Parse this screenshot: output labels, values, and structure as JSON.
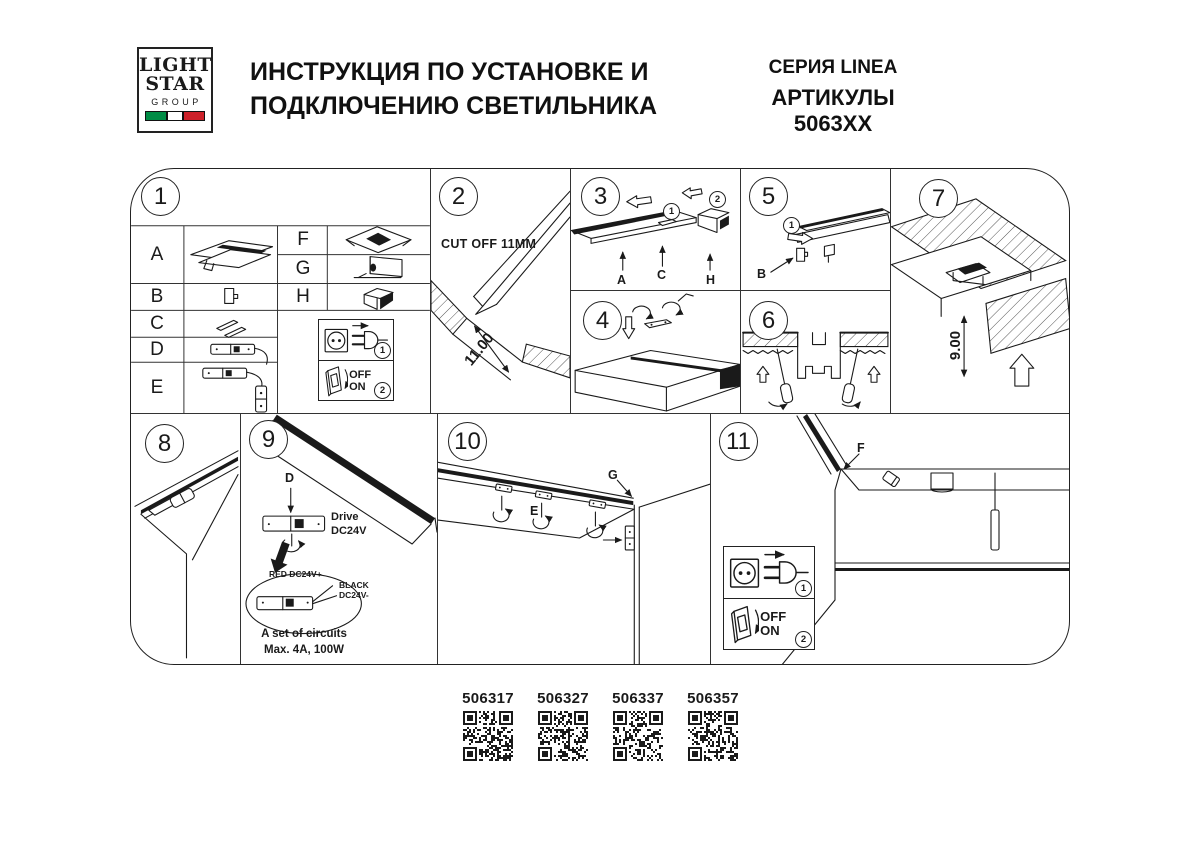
{
  "header": {
    "logo": {
      "word1": "LIGHT",
      "word2": "STAR",
      "word3": "GROUP"
    },
    "title_line1": "ИНСТРУКЦИЯ ПО УСТАНОВКЕ И",
    "title_line2": "ПОДКЛЮЧЕНИЮ СВЕТИЛЬНИКА",
    "series": "СЕРИЯ LINEA",
    "articles": "АРТИКУЛЫ 5063XX"
  },
  "legend": {
    "plug_step": "1",
    "switch_step": "2",
    "off_label": "OFF",
    "on_label": "ON"
  },
  "parts": {
    "a": "A",
    "b": "B",
    "c": "C",
    "d": "D",
    "e": "E",
    "f": "F",
    "g": "G",
    "h": "H"
  },
  "steps": {
    "s1": {
      "number": "1"
    },
    "s2": {
      "number": "2",
      "note": "CUT OFF 11MM",
      "dimension": "11.00"
    },
    "s3": {
      "number": "3",
      "seq1": "1",
      "seq2": "2",
      "part_a": "A",
      "part_c": "C",
      "part_h": "H"
    },
    "s4": {
      "number": "4"
    },
    "s5": {
      "number": "5",
      "seq1": "1",
      "part_b": "B"
    },
    "s6": {
      "number": "6"
    },
    "s7": {
      "number": "7",
      "dimension": "9.00"
    },
    "s8": {
      "number": "8"
    },
    "s9": {
      "number": "9",
      "part_d": "D",
      "driver_line1": "Drive",
      "driver_line2": "DC24V",
      "wire_red": "RED DC24V+",
      "wire_black_line1": "BLACK",
      "wire_black_line2": "DC24V-",
      "circuits_line1": "A set of circuits",
      "circuits_line2": "Max. 4A, 100W"
    },
    "s10": {
      "number": "10",
      "part_e": "E",
      "part_g": "G"
    },
    "s11": {
      "number": "11",
      "part_f": "F"
    }
  },
  "qr_codes": [
    {
      "article": "506317"
    },
    {
      "article": "506327"
    },
    {
      "article": "506337"
    },
    {
      "article": "506357"
    }
  ],
  "colors": {
    "line": "#1a1a1a",
    "flag_green": "#008c45",
    "flag_white": "#ffffff",
    "flag_red": "#cd212a"
  }
}
